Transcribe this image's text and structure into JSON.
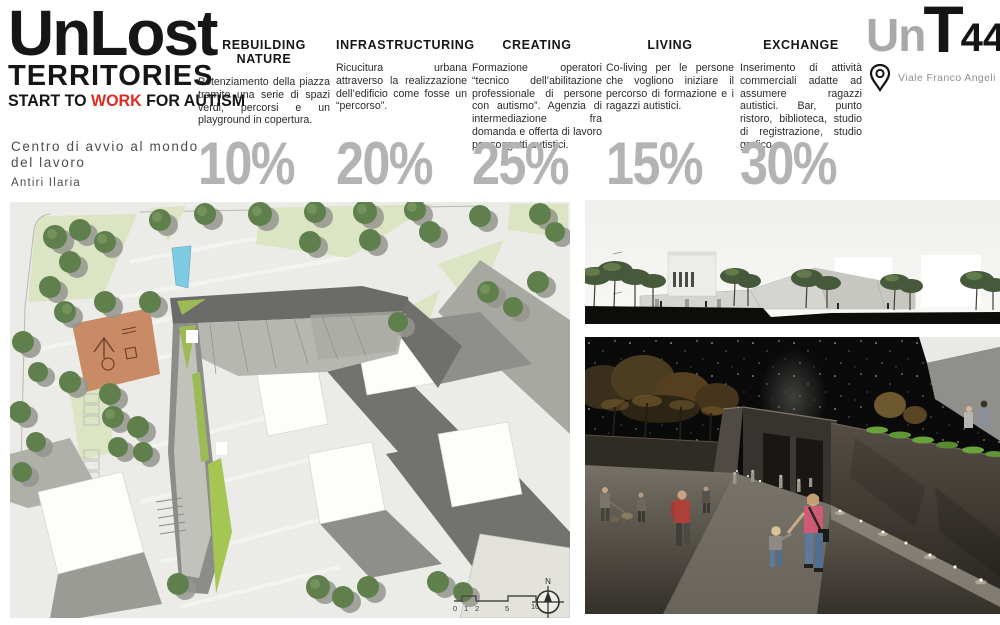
{
  "logo": {
    "line1": "UnLost",
    "line2": "TERRITORIES",
    "tagline_start": "START TO ",
    "tagline_highlight": "WORK",
    "tagline_end": " FOR AUTISM"
  },
  "project": {
    "subtitle": "Centro di avvio al mondo del lavoro",
    "author": "Antiri Ilaria"
  },
  "columns": [
    {
      "title": "REBUILDING NATURE",
      "body": "Potenziamento della piazza tramite una serie di spazi verdi, percorsi e un playground in copertura.",
      "percent": "10%"
    },
    {
      "title": "INFRASTRUCTURING",
      "body": "Ricucitura urbana attraverso la realizzazione dell’edificio come fosse un “percorso”.",
      "percent": "20%"
    },
    {
      "title": "CREATING",
      "body": "Formazione operatori “tecnico dell’abilitazione professionale di persone con autismo”. Agenzia di intermediazione fra domanda e offerta di lavoro per soggetti autistici.",
      "percent": "25%"
    },
    {
      "title": "LIVING",
      "body": "Co-living per le persone che vogliono iniziare il percorso di formazione e i ragazzi autistici.",
      "percent": "15%"
    },
    {
      "title": "EXCHANGE",
      "body": "Inserimento di attività commerciali adatte ad assumere ragazzi autistici. Bar, punto ristoro, biblioteca, studio di registrazione, studio grafico.",
      "percent": "30%"
    }
  ],
  "brand": {
    "part_gray": "Un",
    "part_black": "T",
    "part_number": "44",
    "address": "Viale Franco Angeli"
  },
  "site_plan": {
    "north_label": "N",
    "scale_labels": [
      "0",
      "1",
      "2",
      "5",
      "10"
    ]
  },
  "colors": {
    "accent_red": "#de2a20",
    "percent_gray": "#b3b3b3",
    "brand_gray": "#a9a9a9"
  }
}
